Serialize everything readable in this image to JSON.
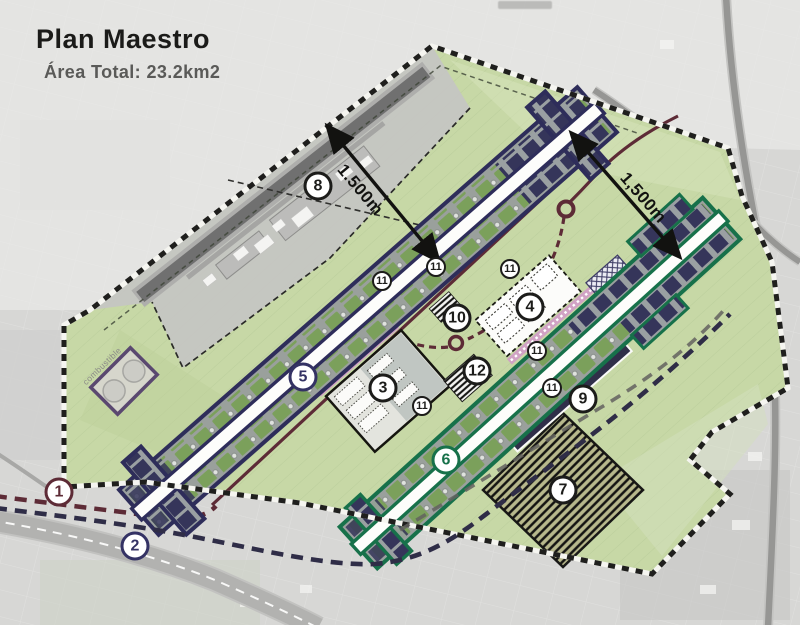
{
  "header": {
    "title": "Plan Maestro",
    "subtitle": "Área Total: 23.2km2"
  },
  "annotations": {
    "dim_left": "1.500m",
    "dim_right": "1,500m",
    "fuel_label": "combustible"
  },
  "markers": {
    "m1": {
      "label": "1",
      "color": "#5d2b36"
    },
    "m2": {
      "label": "2",
      "color": "#343264"
    },
    "m3": {
      "label": "3",
      "color": "#1c1c1a"
    },
    "m4": {
      "label": "4",
      "color": "#1c1c1a"
    },
    "m5": {
      "label": "5",
      "color": "#343264"
    },
    "m6": {
      "label": "6",
      "color": "#17714a"
    },
    "m7": {
      "label": "7",
      "color": "#1c1c1a"
    },
    "m8": {
      "label": "8",
      "color": "#1c1c1a"
    },
    "m9": {
      "label": "9",
      "color": "#1c1c1a"
    },
    "m10": {
      "label": "10",
      "color": "#1c1c1a"
    },
    "m11": {
      "label": "11",
      "color": "#1c1c1a"
    },
    "m12": {
      "label": "12",
      "color": "#1c1c1a"
    }
  },
  "colors": {
    "site_green": "#c7d8a6",
    "runway_blue_outline": "#2e2d5a",
    "runway_green_outline": "#17714a",
    "road_maroon": "#5d2b36",
    "road_navy_dashed": "#2f2d47",
    "existing_airport_gray": "#c5c5c3",
    "boundary_chain_black": "#1f1f1d",
    "boundary_chain_white": "#f5f5f0",
    "terminal_pink": "#d0a2c4"
  }
}
